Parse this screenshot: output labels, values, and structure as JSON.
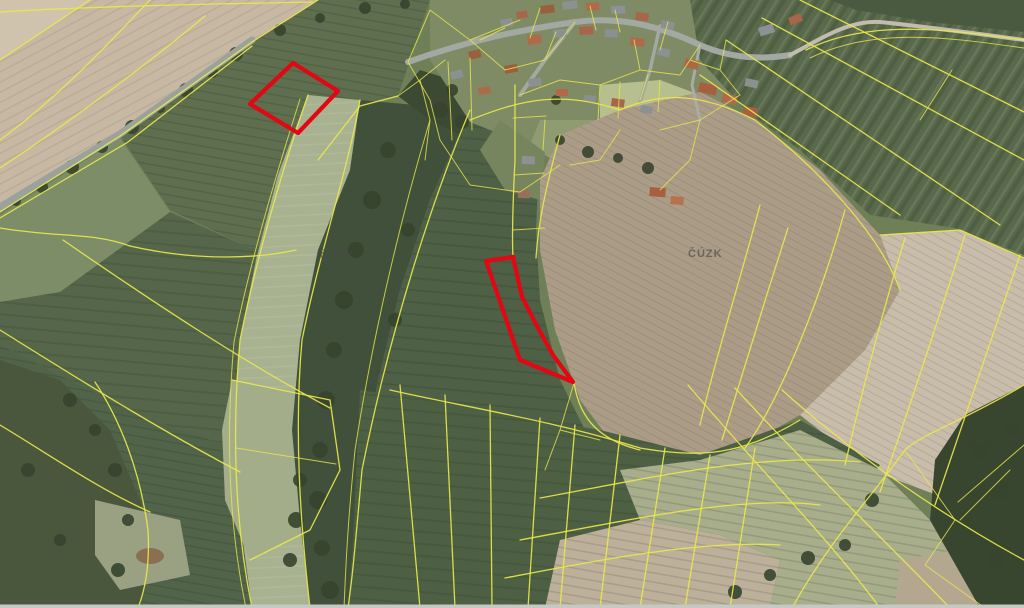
{
  "map": {
    "provider_watermark": "ČÚZK",
    "watermarks": [
      {
        "x": "320",
        "y": "259"
      },
      {
        "x": "688",
        "y": "257"
      }
    ],
    "colors": {
      "parcel_line": "#e9e74b",
      "highlight": "#e30613",
      "watermark": "#4a4a4a",
      "edge_bar": "#c6c8c4"
    },
    "highlighted_parcels": [
      {
        "label": "parcel-northwest",
        "points": "293,63 338,91 298,133 250,104"
      },
      {
        "label": "parcel-central",
        "points": "486,261 513,257 522,297 538,328 553,355 573,382 520,360"
      }
    ]
  }
}
